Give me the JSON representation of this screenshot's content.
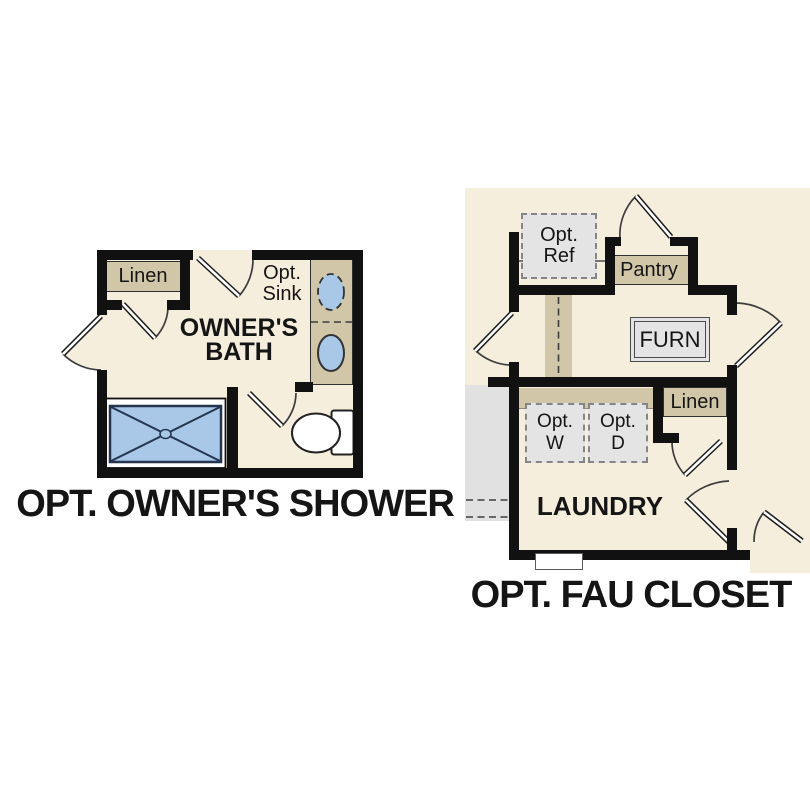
{
  "colors": {
    "floor": "#f6eedd",
    "cabinet": "#d2c6a8",
    "fixture_blue": "#a9c8e8",
    "optional_gray": "#e4e4e4",
    "wall": "#111111",
    "line": "#3d3d3d"
  },
  "left_plan": {
    "title": "OPT. OWNER'S SHOWER",
    "room_label": {
      "line1": "OWNER'S",
      "line2": "BATH"
    },
    "linen_label": "Linen",
    "opt_sink_label": {
      "line1": "Opt.",
      "line2": "Sink"
    }
  },
  "right_plan": {
    "title": "OPT. FAU CLOSET",
    "laundry_label": "LAUNDRY",
    "pantry_label": "Pantry",
    "furn_label": "FURN",
    "linen_label": "Linen",
    "opt_ref_label": {
      "line1": "Opt.",
      "line2": "Ref"
    },
    "opt_washer_label": {
      "line1": "Opt.",
      "line2": "W"
    },
    "opt_dryer_label": {
      "line1": "Opt.",
      "line2": "D"
    }
  }
}
